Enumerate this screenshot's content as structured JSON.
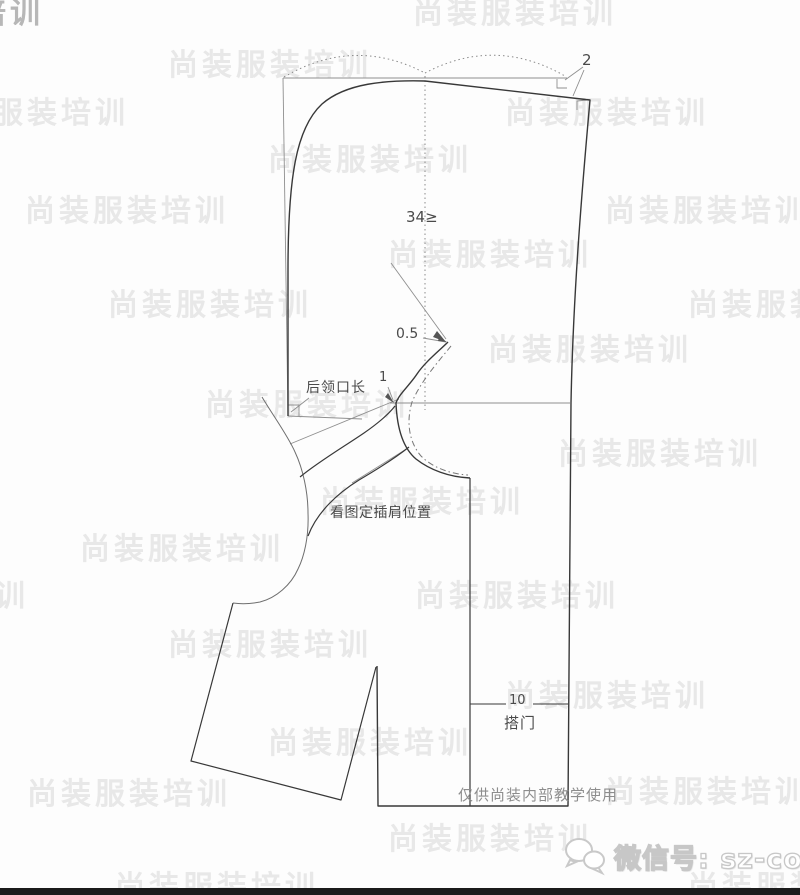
{
  "watermark": {
    "text": "尚装服装培训"
  },
  "diagram": {
    "title": "raglan-hood-pattern-draft",
    "annotations": {
      "top_right_value": "2",
      "width_value": "34≥",
      "gap_value": "0.5",
      "neck_point_value": "1",
      "back_neck_label": "后领口长",
      "raglan_position_label": "看图定插肩位置",
      "overlap_width_value": "10",
      "overlap_label": "搭门"
    },
    "colors": {
      "outline": "#383838",
      "construction": "#8f8f8f",
      "watermark": "#e8e8e8",
      "label_text": "#4a4a4a",
      "bottom_bar": "#1b1b1b"
    }
  },
  "footer": {
    "notice": "仅供尚装内部教学使用",
    "wechat_label": "微信号: sz-college",
    "wechat_icon": "wechat-bubbles-icon"
  }
}
